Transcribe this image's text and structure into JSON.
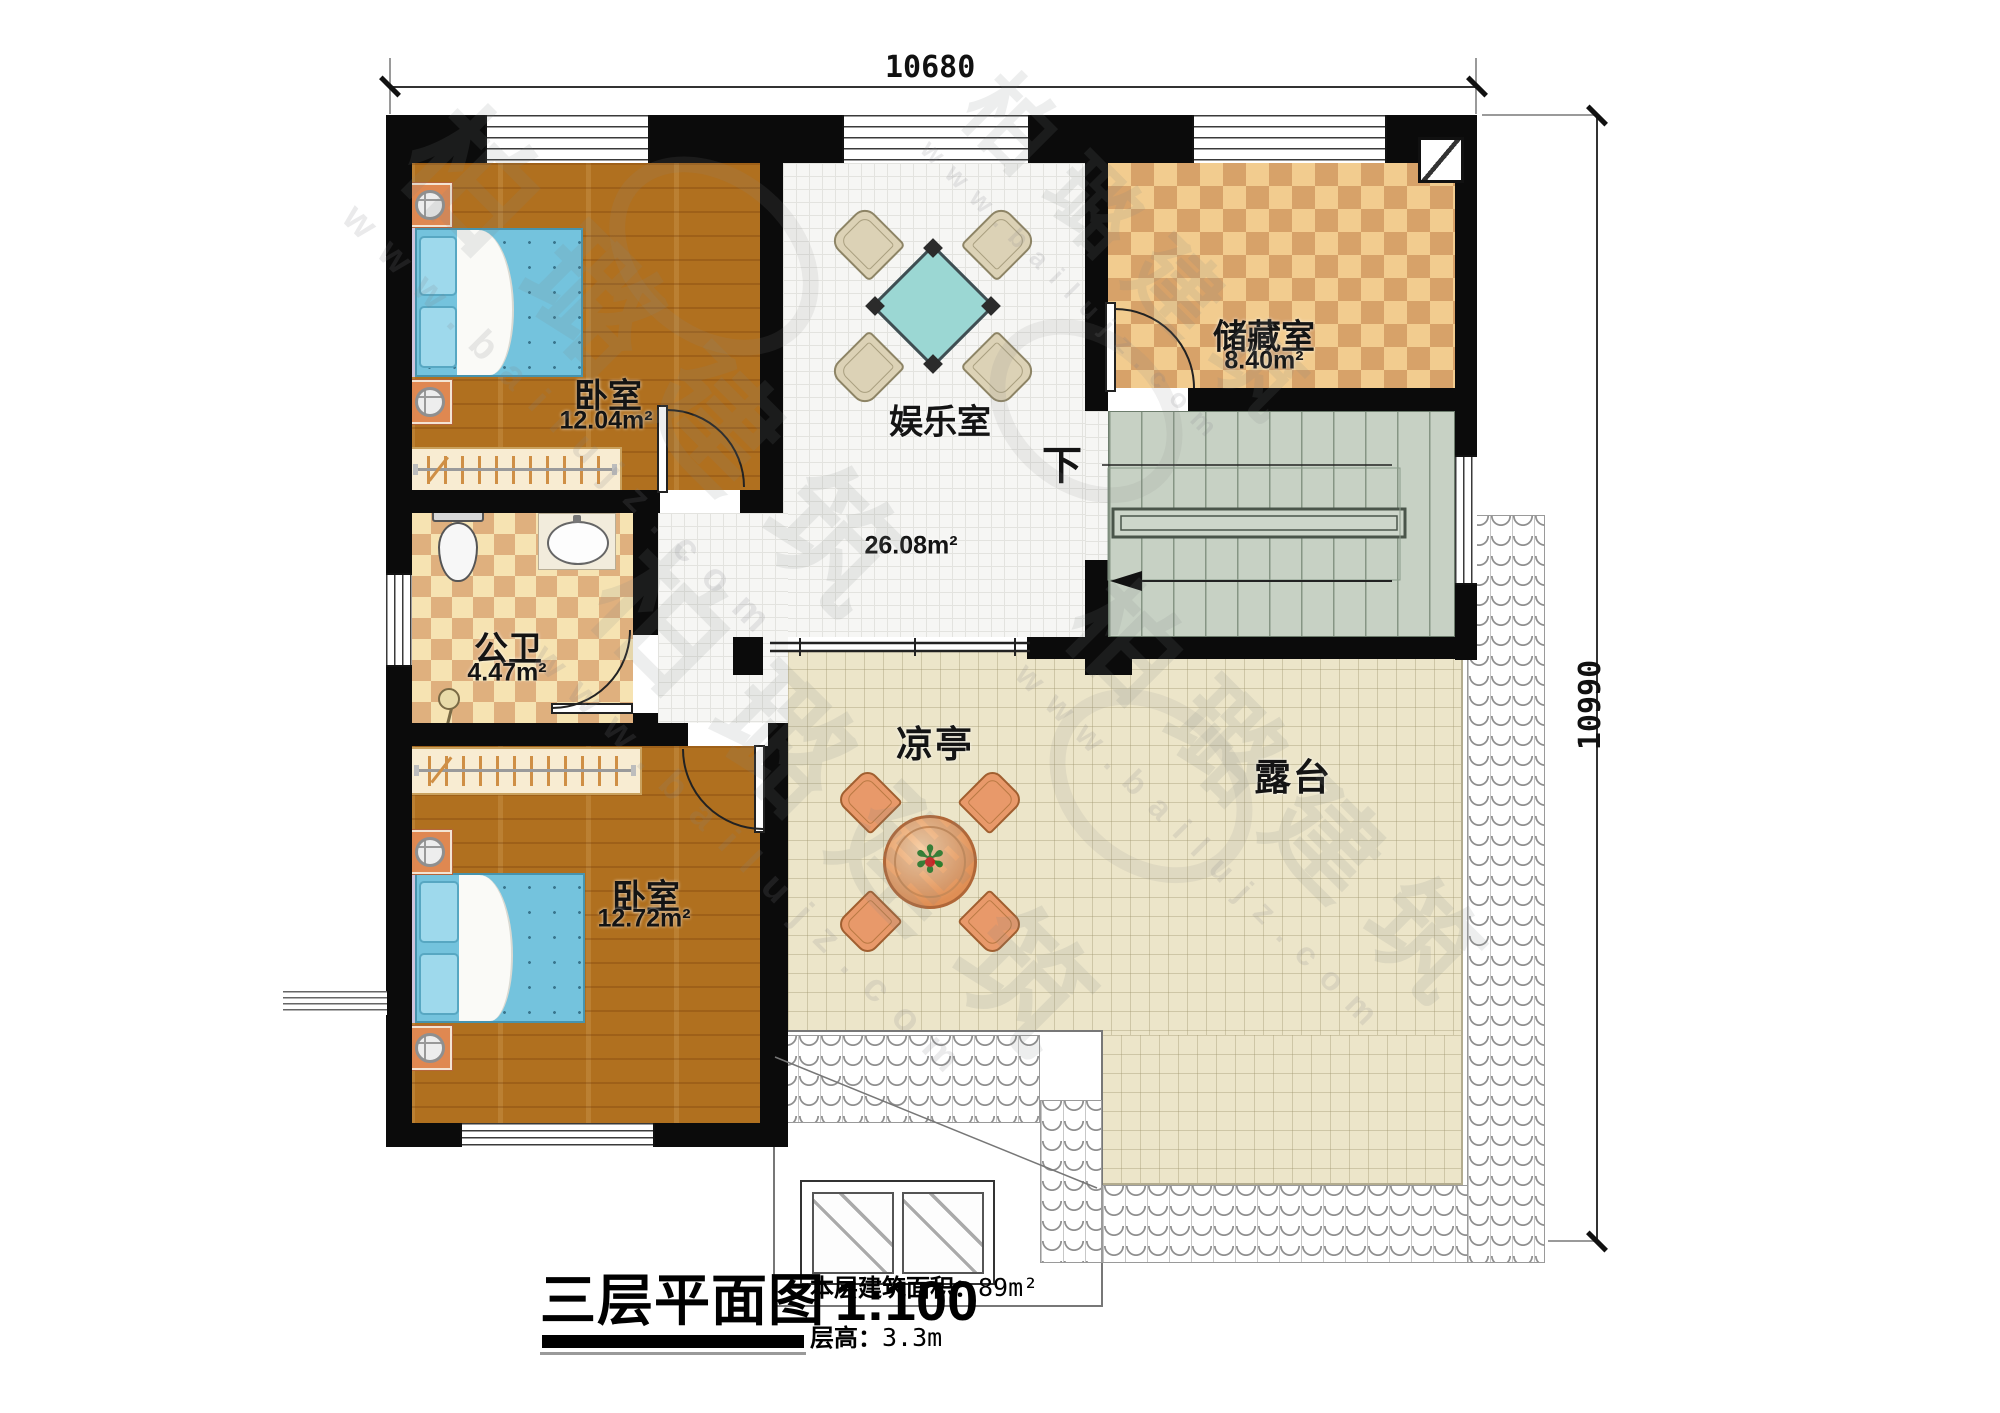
{
  "plan": {
    "dimensions": {
      "top": "10680",
      "right": "10990"
    },
    "rooms": {
      "bedroom1": {
        "label": "卧室",
        "area": "12.04m²"
      },
      "entertainment": {
        "label": "娱乐室",
        "area": "26.08m²"
      },
      "storage": {
        "label": "储藏室",
        "area": "8.40m²"
      },
      "bathroom": {
        "label": "公卫",
        "area": "4.47m²"
      },
      "bedroom2": {
        "label": "卧室",
        "area": "12.72m²"
      },
      "pavilion": {
        "label": "凉亭"
      },
      "terrace": {
        "label": "露台"
      }
    },
    "stairs": {
      "down_label": "下"
    }
  },
  "title_block": {
    "title": "三层平面图",
    "scale": "1:100",
    "area_label": "本层建筑面积：",
    "area_value": "89m²",
    "floor_height_label": "层高：",
    "floor_height_value": "3.3m"
  },
  "watermark": {
    "brand": "柏璐建筑",
    "site": "www.bailujz.com"
  },
  "colors": {
    "wall": "#0b0b0b",
    "wood_floor": "#b0701f",
    "tile_light": "#f2cc8f",
    "tile_dark": "#d7a269",
    "stair": "#c7d1c4",
    "terrace": "#ece5c9",
    "bed": "#74c3dd"
  }
}
